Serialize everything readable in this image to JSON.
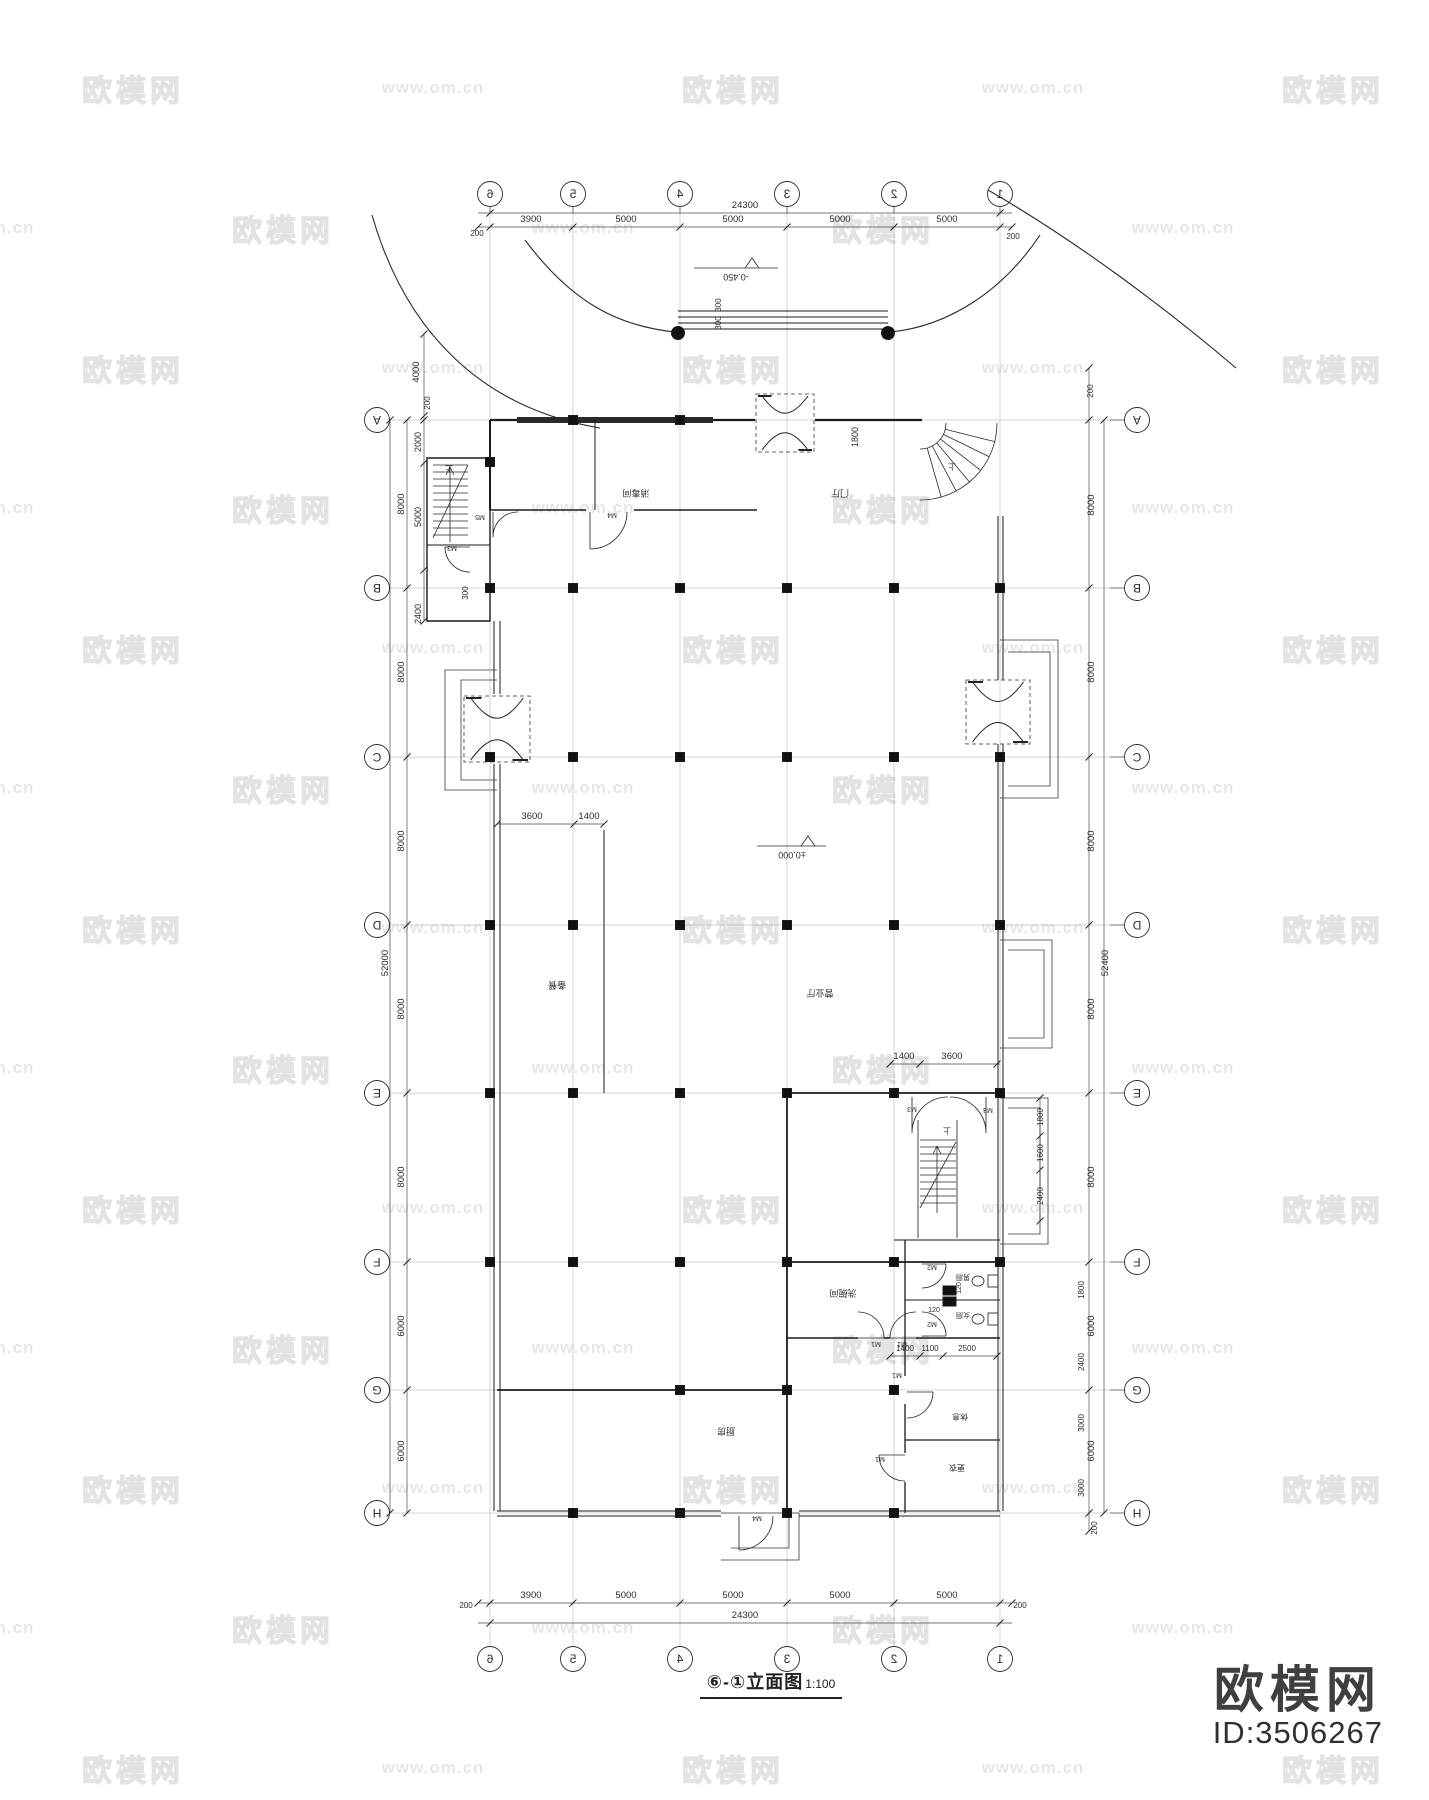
{
  "watermark": {
    "brand": "欧模网",
    "url": "www.om.cn",
    "row_start_y": 88,
    "row_pitch": 140,
    "col_pitch": 300,
    "even_row_x0": 133,
    "odd_row_x0": -17,
    "rows": 13
  },
  "logo": {
    "brand": "欧模网",
    "model_id": "ID:3506267"
  },
  "title_block": {
    "title": "⑥-①立面图",
    "scale": "1:100"
  },
  "axes": {
    "cols": {
      "labels": [
        "6",
        "5",
        "4",
        "3",
        "2",
        "1"
      ],
      "x": [
        490,
        573,
        680,
        787,
        894,
        1000
      ],
      "top_bubble_y": 194,
      "bottom_bubble_y": 1659
    },
    "rows": {
      "labels": [
        "A",
        "B",
        "C",
        "D",
        "E",
        "F",
        "G",
        "H"
      ],
      "y": [
        420,
        588,
        757,
        925,
        1093,
        1262,
        1390,
        1513
      ],
      "left_bubble_x": 377,
      "right_bubble_x": 1137
    }
  },
  "dim_texts": [
    {
      "t": "24300",
      "x": 745,
      "y": 208
    },
    {
      "t": "3900",
      "x": 531,
      "y": 222
    },
    {
      "t": "5000",
      "x": 626,
      "y": 222
    },
    {
      "t": "5000",
      "x": 733,
      "y": 222
    },
    {
      "t": "5000",
      "x": 840,
      "y": 222
    },
    {
      "t": "5000",
      "x": 947,
      "y": 222
    },
    {
      "t": "200",
      "x": 477,
      "y": 236,
      "s": 8
    },
    {
      "t": "200",
      "x": 1013,
      "y": 239,
      "s": 8
    },
    {
      "t": "3900",
      "x": 531,
      "y": 1598
    },
    {
      "t": "5000",
      "x": 626,
      "y": 1598
    },
    {
      "t": "5000",
      "x": 733,
      "y": 1598
    },
    {
      "t": "5000",
      "x": 840,
      "y": 1598
    },
    {
      "t": "5000",
      "x": 947,
      "y": 1598
    },
    {
      "t": "24300",
      "x": 745,
      "y": 1618
    },
    {
      "t": "200",
      "x": 466,
      "y": 1608,
      "s": 8
    },
    {
      "t": "200",
      "x": 1020,
      "y": 1608,
      "s": 8
    },
    {
      "t": "52000",
      "x": 388,
      "y": 963,
      "r": -90
    },
    {
      "t": "8000",
      "x": 404,
      "y": 504,
      "r": -90
    },
    {
      "t": "8000",
      "x": 404,
      "y": 672,
      "r": -90
    },
    {
      "t": "8000",
      "x": 404,
      "y": 841,
      "r": -90
    },
    {
      "t": "8000",
      "x": 404,
      "y": 1009,
      "r": -90
    },
    {
      "t": "8000",
      "x": 404,
      "y": 1177,
      "r": -90
    },
    {
      "t": "6000",
      "x": 404,
      "y": 1326,
      "r": -90
    },
    {
      "t": "6000",
      "x": 404,
      "y": 1451,
      "r": -90
    },
    {
      "t": "4000",
      "x": 419,
      "y": 372,
      "r": -90
    },
    {
      "t": "200",
      "x": 430,
      "y": 403,
      "r": -90,
      "s": 8
    },
    {
      "t": "2000",
      "x": 421,
      "y": 442,
      "r": -90,
      "s": 9
    },
    {
      "t": "5000",
      "x": 421,
      "y": 517,
      "r": -90,
      "s": 9
    },
    {
      "t": "2400",
      "x": 421,
      "y": 614,
      "r": -90,
      "s": 9
    },
    {
      "t": "300",
      "x": 468,
      "y": 593,
      "r": -90,
      "s": 8
    },
    {
      "t": "52400",
      "x": 1108,
      "y": 963,
      "r": -90
    },
    {
      "t": "200",
      "x": 1093,
      "y": 391,
      "r": -90,
      "s": 8
    },
    {
      "t": "8000",
      "x": 1094,
      "y": 505,
      "r": -90
    },
    {
      "t": "8000",
      "x": 1094,
      "y": 672,
      "r": -90
    },
    {
      "t": "8000",
      "x": 1094,
      "y": 841,
      "r": -90
    },
    {
      "t": "8000",
      "x": 1094,
      "y": 1009,
      "r": -90
    },
    {
      "t": "8000",
      "x": 1094,
      "y": 1177,
      "r": -90
    },
    {
      "t": "6000",
      "x": 1094,
      "y": 1326,
      "r": -90
    },
    {
      "t": "6000",
      "x": 1094,
      "y": 1451,
      "r": -90
    },
    {
      "t": "1800",
      "x": 1084,
      "y": 1290,
      "r": -90,
      "s": 8
    },
    {
      "t": "2400",
      "x": 1084,
      "y": 1362,
      "r": -90,
      "s": 8
    },
    {
      "t": "3000",
      "x": 1084,
      "y": 1423,
      "r": -90,
      "s": 8
    },
    {
      "t": "3000",
      "x": 1084,
      "y": 1488,
      "r": -90,
      "s": 8
    },
    {
      "t": "200",
      "x": 1097,
      "y": 1528,
      "r": -90,
      "s": 8
    },
    {
      "t": "1800",
      "x": 1043,
      "y": 1117,
      "r": -90,
      "s": 8
    },
    {
      "t": "1600",
      "x": 1043,
      "y": 1153,
      "r": -90,
      "s": 8
    },
    {
      "t": "2400",
      "x": 1043,
      "y": 1196,
      "r": -90,
      "s": 8
    },
    {
      "t": "3600",
      "x": 532,
      "y": 819
    },
    {
      "t": "1400",
      "x": 589,
      "y": 819
    },
    {
      "t": "1400",
      "x": 904,
      "y": 1059
    },
    {
      "t": "3600",
      "x": 952,
      "y": 1059
    },
    {
      "t": "1400",
      "x": 905,
      "y": 1351,
      "s": 8
    },
    {
      "t": "1100",
      "x": 930,
      "y": 1351,
      "s": 8
    },
    {
      "t": "2500",
      "x": 967,
      "y": 1351,
      "s": 8
    },
    {
      "t": "120",
      "x": 961,
      "y": 1288,
      "r": -90,
      "s": 7
    },
    {
      "t": "120",
      "x": 934,
      "y": 1312,
      "s": 7
    },
    {
      "t": "1800",
      "x": 858,
      "y": 437,
      "r": -90,
      "s": 9
    },
    {
      "t": "300",
      "x": 721,
      "y": 305,
      "r": -90,
      "s": 8
    },
    {
      "t": "300",
      "x": 721,
      "y": 323,
      "r": -90,
      "s": 8
    }
  ],
  "labels": [
    {
      "t": "消毒间",
      "x": 636,
      "y": 496,
      "s": 9
    },
    {
      "t": "门厅",
      "x": 840,
      "y": 496,
      "s": 9
    },
    {
      "t": "营业厅",
      "x": 820,
      "y": 996,
      "s": 9
    },
    {
      "t": "备餐",
      "x": 557,
      "y": 988,
      "s": 9
    },
    {
      "t": "洗碗间",
      "x": 843,
      "y": 1296,
      "s": 9
    },
    {
      "t": "厨房",
      "x": 726,
      "y": 1434,
      "s": 9
    },
    {
      "t": "休息",
      "x": 960,
      "y": 1420,
      "s": 8
    },
    {
      "t": "更衣",
      "x": 957,
      "y": 1471,
      "s": 8
    },
    {
      "t": "男厕",
      "x": 963,
      "y": 1281,
      "s": 7
    },
    {
      "t": "女厕",
      "x": 963,
      "y": 1319,
      "s": 7
    },
    {
      "t": "M4",
      "x": 612,
      "y": 519,
      "s": 7
    },
    {
      "t": "M5",
      "x": 480,
      "y": 521,
      "s": 7
    },
    {
      "t": "M3",
      "x": 452,
      "y": 552,
      "s": 7
    },
    {
      "t": "M3",
      "x": 912,
      "y": 1113,
      "s": 7
    },
    {
      "t": "M3",
      "x": 988,
      "y": 1114,
      "s": 7
    },
    {
      "t": "M1",
      "x": 876,
      "y": 1348,
      "s": 7
    },
    {
      "t": "M1",
      "x": 902,
      "y": 1348,
      "s": 7
    },
    {
      "t": "M1",
      "x": 897,
      "y": 1379,
      "s": 7
    },
    {
      "t": "M1",
      "x": 880,
      "y": 1463,
      "s": 7
    },
    {
      "t": "M2",
      "x": 932,
      "y": 1271,
      "s": 7
    },
    {
      "t": "M2",
      "x": 932,
      "y": 1328,
      "s": 7
    },
    {
      "t": "M4",
      "x": 757,
      "y": 1522,
      "s": 7
    },
    {
      "t": "上",
      "x": 449,
      "y": 472,
      "s": 8
    },
    {
      "t": "上",
      "x": 947,
      "y": 1134,
      "s": 8
    },
    {
      "t": "上",
      "x": 952,
      "y": 470,
      "s": 8
    },
    {
      "t": "-0.450",
      "x": 736,
      "y": 280,
      "s": 9
    },
    {
      "t": "±0.000",
      "x": 792,
      "y": 858,
      "s": 9
    }
  ]
}
